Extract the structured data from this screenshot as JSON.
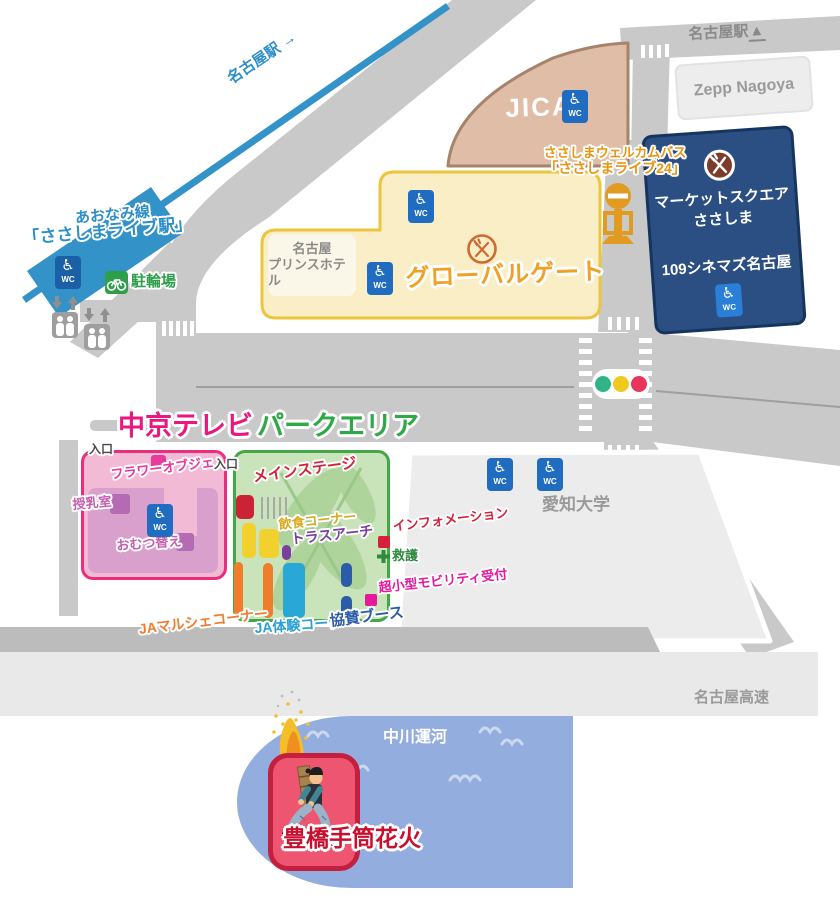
{
  "rail": {
    "to_station": "名古屋駅",
    "arrow": "→"
  },
  "station": {
    "line": "あおなみ線",
    "name": "「ささしまライブ駅」"
  },
  "facilities": {
    "bike_parking": "駐輪場",
    "wc": "WC"
  },
  "top_right": {
    "station": "名古屋駅",
    "arrow": "▲",
    "zepp": "Zepp Nagoya"
  },
  "jica": {
    "name": "JICA"
  },
  "bus_stop": {
    "line1": "ささしまウェルカムバス",
    "line2": "「ささしまライブ24」"
  },
  "market_square": {
    "name_line1": "マーケットスクエア",
    "name_line2": "ささしま",
    "cinema": "109シネマズ名古屋"
  },
  "global_gate": {
    "name": "グローバルゲート",
    "hotel_line1": "名古屋",
    "hotel_line2": "プリンスホテル"
  },
  "chukyo_tv": {
    "title": "中京テレビ",
    "entrance": "入口",
    "flower_object": "フラワーオブジェ",
    "nursing_room": "授乳室",
    "diaper_change": "おむつ替え"
  },
  "park_area": {
    "title": "パークエリア",
    "entrance": "入口",
    "main_stage": "メインステージ",
    "food_corner": "飲食コーナー",
    "truss_arch": "トラスアーチ",
    "information": "インフォメーション",
    "first_aid": "救護",
    "mobility_reception": "超小型モビリティ受付",
    "ja_marche": "JAマルシェコーナー",
    "ja_experience": "JA体験コーナー",
    "sponsor_booth": "協賛ブース"
  },
  "aichi_university": {
    "name": "愛知大学"
  },
  "expressway": {
    "name": "名古屋高速"
  },
  "canal": {
    "name": "中川運河"
  },
  "tezutsu": {
    "name": "豊橋手筒花火"
  },
  "icons": {
    "wheelchair": "♿"
  },
  "colors": {
    "rail_blue": "#3392c8",
    "jica_tan": "#dfbda6",
    "market_navy": "#2b4f82",
    "global_gate_yellow": "#faeec6",
    "global_gate_border": "#ecc53e",
    "chukyo_pink_border": "#ea2e7d",
    "chukyo_pink_fill": "#f2bad4",
    "park_green_border": "#43a648",
    "park_green_fill": "#c9e3ba",
    "canal_blue": "#93aede",
    "stage_red": "#cc2235",
    "signal_green": "#2eb488",
    "signal_yellow": "#f0c81e",
    "signal_red": "#e8355e",
    "fireworks_red": "#c8102e",
    "bus_orange": "#e8950f",
    "road_gray": "#c9c9c9"
  }
}
